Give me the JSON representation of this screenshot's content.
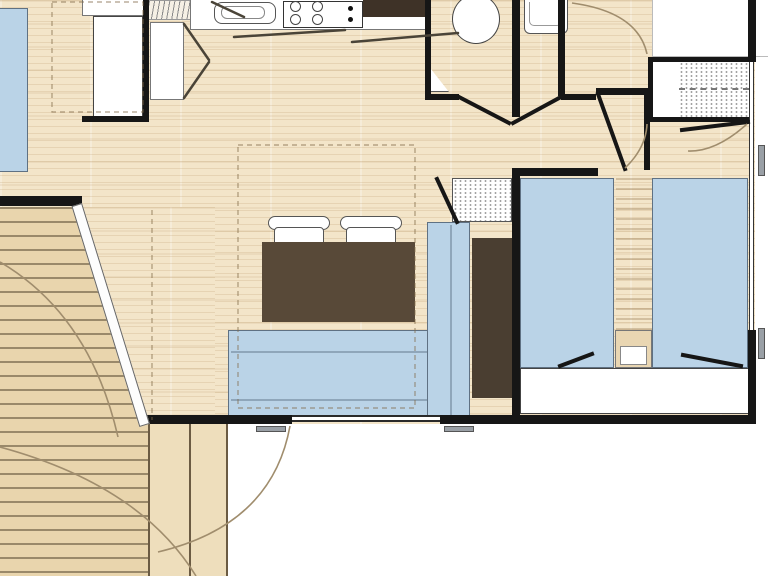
{
  "plan": {
    "canvas": {
      "width": 768,
      "height": 576
    },
    "colors": {
      "floor_wood": "#f3e5c9",
      "deck_wood": "#e9d5ad",
      "wall": "#161616",
      "furniture_blue": "#bad3e7",
      "furniture_blue_border": "#5f7183",
      "table_brown": "#584938",
      "cabinet_brown": "#4a3e31",
      "nightstand_tan": "#e9d6b2",
      "handle_grey": "#9aa0a6",
      "swing_line": "#a08d6d",
      "outline_grey": "#555555"
    },
    "rooms": [
      {
        "name": "living-kitchen",
        "floor": "wood"
      },
      {
        "name": "master-bedroom",
        "floor": "wood"
      },
      {
        "name": "wc",
        "floor": "wood"
      },
      {
        "name": "washroom",
        "floor": "wood"
      },
      {
        "name": "shower-room",
        "floor": "white",
        "feature": "hatched-shower-tray"
      },
      {
        "name": "twin-bedroom",
        "floor": "wood"
      },
      {
        "name": "hallway",
        "floor": "wood"
      },
      {
        "name": "deck-terrace",
        "floor": "deck-planks"
      }
    ],
    "furniture": [
      {
        "name": "kitchen-counter"
      },
      {
        "name": "kitchen-sink"
      },
      {
        "name": "cooktop-4-burners"
      },
      {
        "name": "draining-board"
      },
      {
        "name": "tall-fridge-unit"
      },
      {
        "name": "kitchen-cabinet"
      },
      {
        "name": "dining-table"
      },
      {
        "name": "chair",
        "count": 2
      },
      {
        "name": "l-shaped-sofa"
      },
      {
        "name": "tall-storage-cabinet"
      },
      {
        "name": "hatched-storage-shelf"
      },
      {
        "name": "master-bed"
      },
      {
        "name": "toilet"
      },
      {
        "name": "washbasin"
      },
      {
        "name": "corner-shelf"
      },
      {
        "name": "shower-tray"
      },
      {
        "name": "twin-bed",
        "count": 2
      },
      {
        "name": "nightstand"
      },
      {
        "name": "foot-of-bed-cabinet"
      }
    ],
    "openings": [
      {
        "name": "patio-sliding-door",
        "state": "open-diagonal"
      },
      {
        "name": "entry-door-swing"
      },
      {
        "name": "wc-door"
      },
      {
        "name": "washroom-door"
      },
      {
        "name": "twin-bedroom-door"
      },
      {
        "name": "shower-room-door"
      },
      {
        "name": "bottom-window",
        "handles": 2
      },
      {
        "name": "right-wall-windows",
        "handles": 2
      }
    ]
  }
}
